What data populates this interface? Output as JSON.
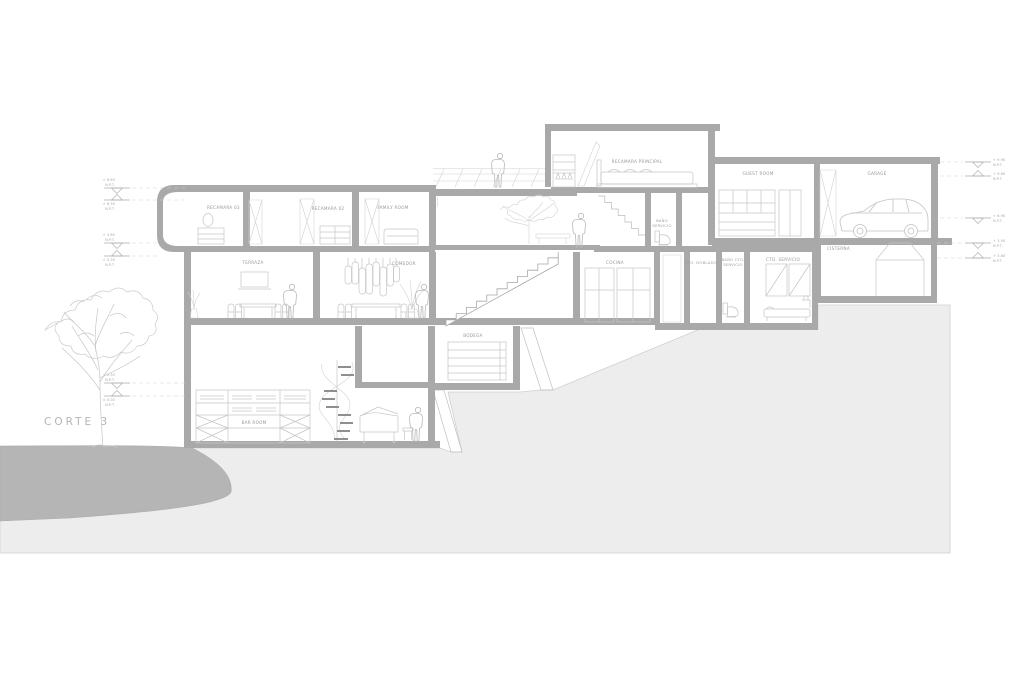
{
  "drawing": {
    "title": "CORTE 3",
    "rooms": {
      "recamara_principal": "RECAMARA PRINCIPAL",
      "bano_servicio_1": "BAÑO",
      "bano_servicio_2": "SERVICIO",
      "guest_room": "GUEST ROOM",
      "garage": "GARAGE",
      "recamara_03": "RECAMARA 03",
      "recamara_02": "RECAMARA 02",
      "family_room": "FAMILY ROOM",
      "terraza": "TERRAZA",
      "comedor": "COMEDOR",
      "cocina": "COCINA",
      "cto_doblado": "CTO. DOBLADO",
      "bano_cto_servicio_1": "BAÑO CTO.",
      "bano_cto_servicio_2": "SERVICIO",
      "cto_servicio": "CTO. SERVICIO",
      "cisterna": "CISTERNA",
      "bodega": "BODEGA",
      "bar_room": "BAR ROOM"
    },
    "levels_left": [
      {
        "value": "+ 6.60",
        "datum": "N.P.T."
      },
      {
        "value": "+ 6.30",
        "datum": "N.P.T."
      },
      {
        "value": "+ 3.60",
        "datum": "N.P.T."
      },
      {
        "value": "+ 3.30",
        "datum": "N.P.T."
      },
      {
        "value": "+ 0.30",
        "datum": "N.P.T."
      },
      {
        "value": "± 0.00",
        "datum": "N.P.T."
      }
    ],
    "levels_right": [
      {
        "value": "+ 9.90",
        "datum": "N.P.T."
      },
      {
        "value": "+ 9.60",
        "datum": "N.P.T."
      },
      {
        "value": "+ 6.90",
        "datum": "N.P.T."
      },
      {
        "value": "+ 3.90",
        "datum": "N.P.T."
      },
      {
        "value": "+ 3.60",
        "datum": "N.P.T."
      }
    ],
    "colors": {
      "wall": "#a9a9a9",
      "detail_line": "#c6c6c6",
      "label": "#999999",
      "terrain_light": "#ededed",
      "terrain_dark": "#b5b5b5"
    }
  }
}
